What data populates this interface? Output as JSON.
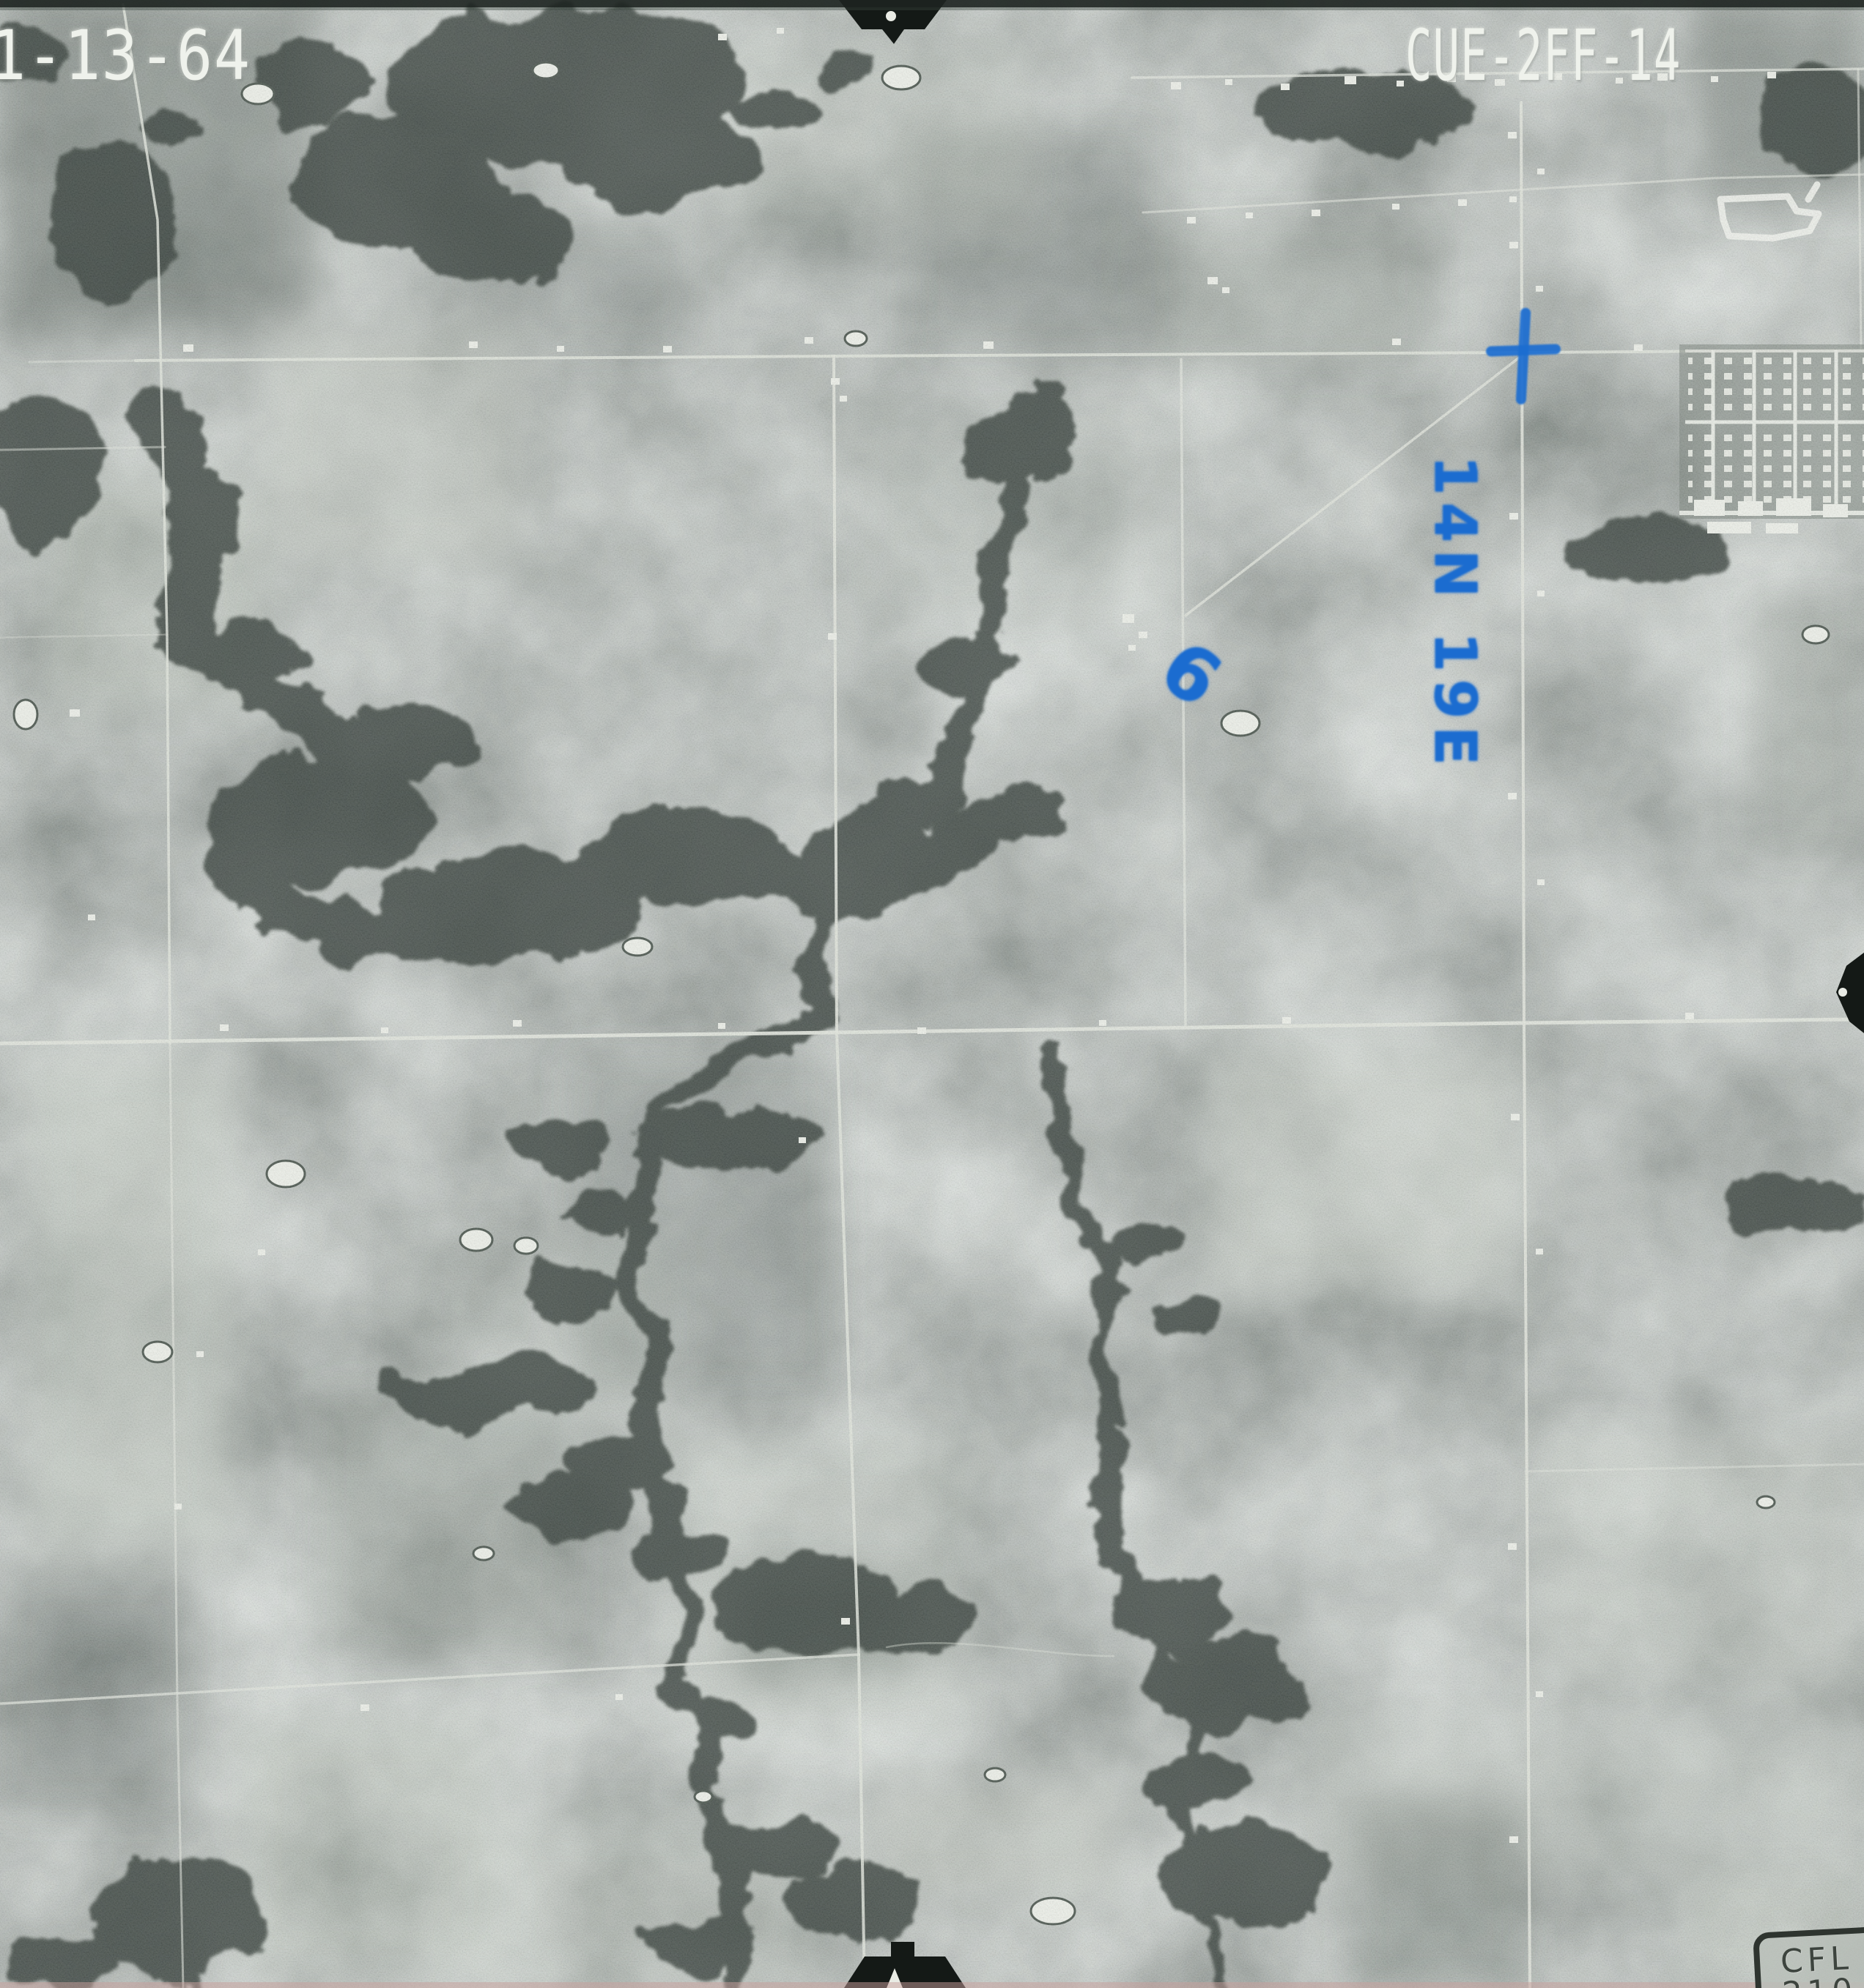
{
  "photo": {
    "date_stamp": "1-13-64",
    "photo_id": "CUE-2FF-14",
    "corner_stamp": "CFL 210.37",
    "type": "black-and-white aerial survey photograph"
  },
  "annotations": {
    "township_range": "14N 19E",
    "section_number": "6",
    "cross_mark": "survey-cross",
    "ink_color": "#1b6cd0"
  },
  "film_marks": {
    "top_center": "fiducial-arrow-down",
    "bottom_center": "fiducial-arrow-up",
    "right_edge": "fiducial-arrow-left"
  },
  "colors": {
    "stencil_text": "#eff2ec",
    "stamp_text": "#3d443e",
    "fiducial": "#141916",
    "terrain_base": "#8e988f"
  }
}
